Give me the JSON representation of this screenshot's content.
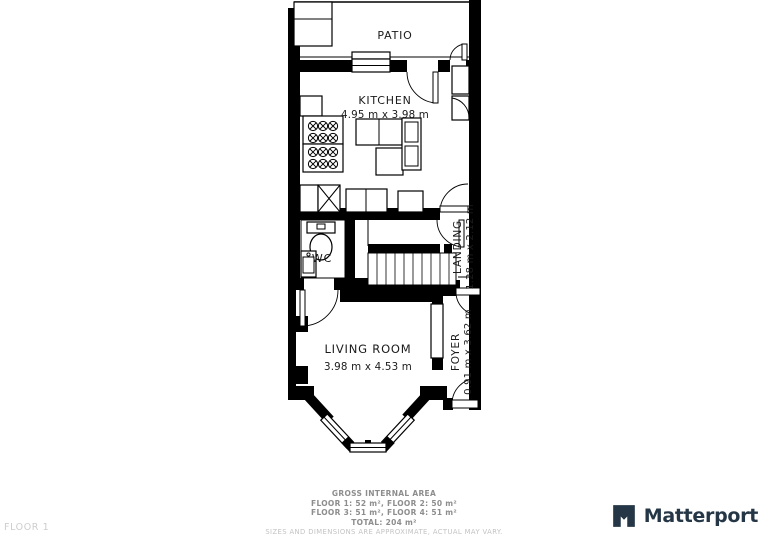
{
  "floor_tag": "FLOOR 1",
  "rooms": {
    "patio": {
      "name": "PATIO"
    },
    "kitchen": {
      "name": "KITCHEN",
      "dims": "4.95 m x 3.98 m"
    },
    "wc": {
      "name": "WC"
    },
    "landing": {
      "name": "LANDING",
      "dims": "1.28 m x 2.12 m"
    },
    "living": {
      "name": "LIVING ROOM",
      "dims": "3.98 m x 4.53 m"
    },
    "foyer": {
      "name": "FOYER",
      "dims": "0.91 m x 3.62 m"
    }
  },
  "footer": {
    "title": "GROSS INTERNAL AREA",
    "line1": "FLOOR 1: 52 m², FLOOR 2: 50 m²",
    "line2": "FLOOR 3: 51 m², FLOOR 4: 51 m²",
    "total": "TOTAL: 204 m²",
    "disclaimer": "SIZES AND DIMENSIONS ARE APPROXIMATE, ACTUAL MAY VARY."
  },
  "branding": {
    "logo_text": "Matterport"
  },
  "colors": {
    "wall": "#000000",
    "background": "#ffffff",
    "label_text": "#1b1b1b",
    "footer_text": "#8d8d8d",
    "faint_text": "#c3c3c3",
    "logo": "#253746"
  }
}
